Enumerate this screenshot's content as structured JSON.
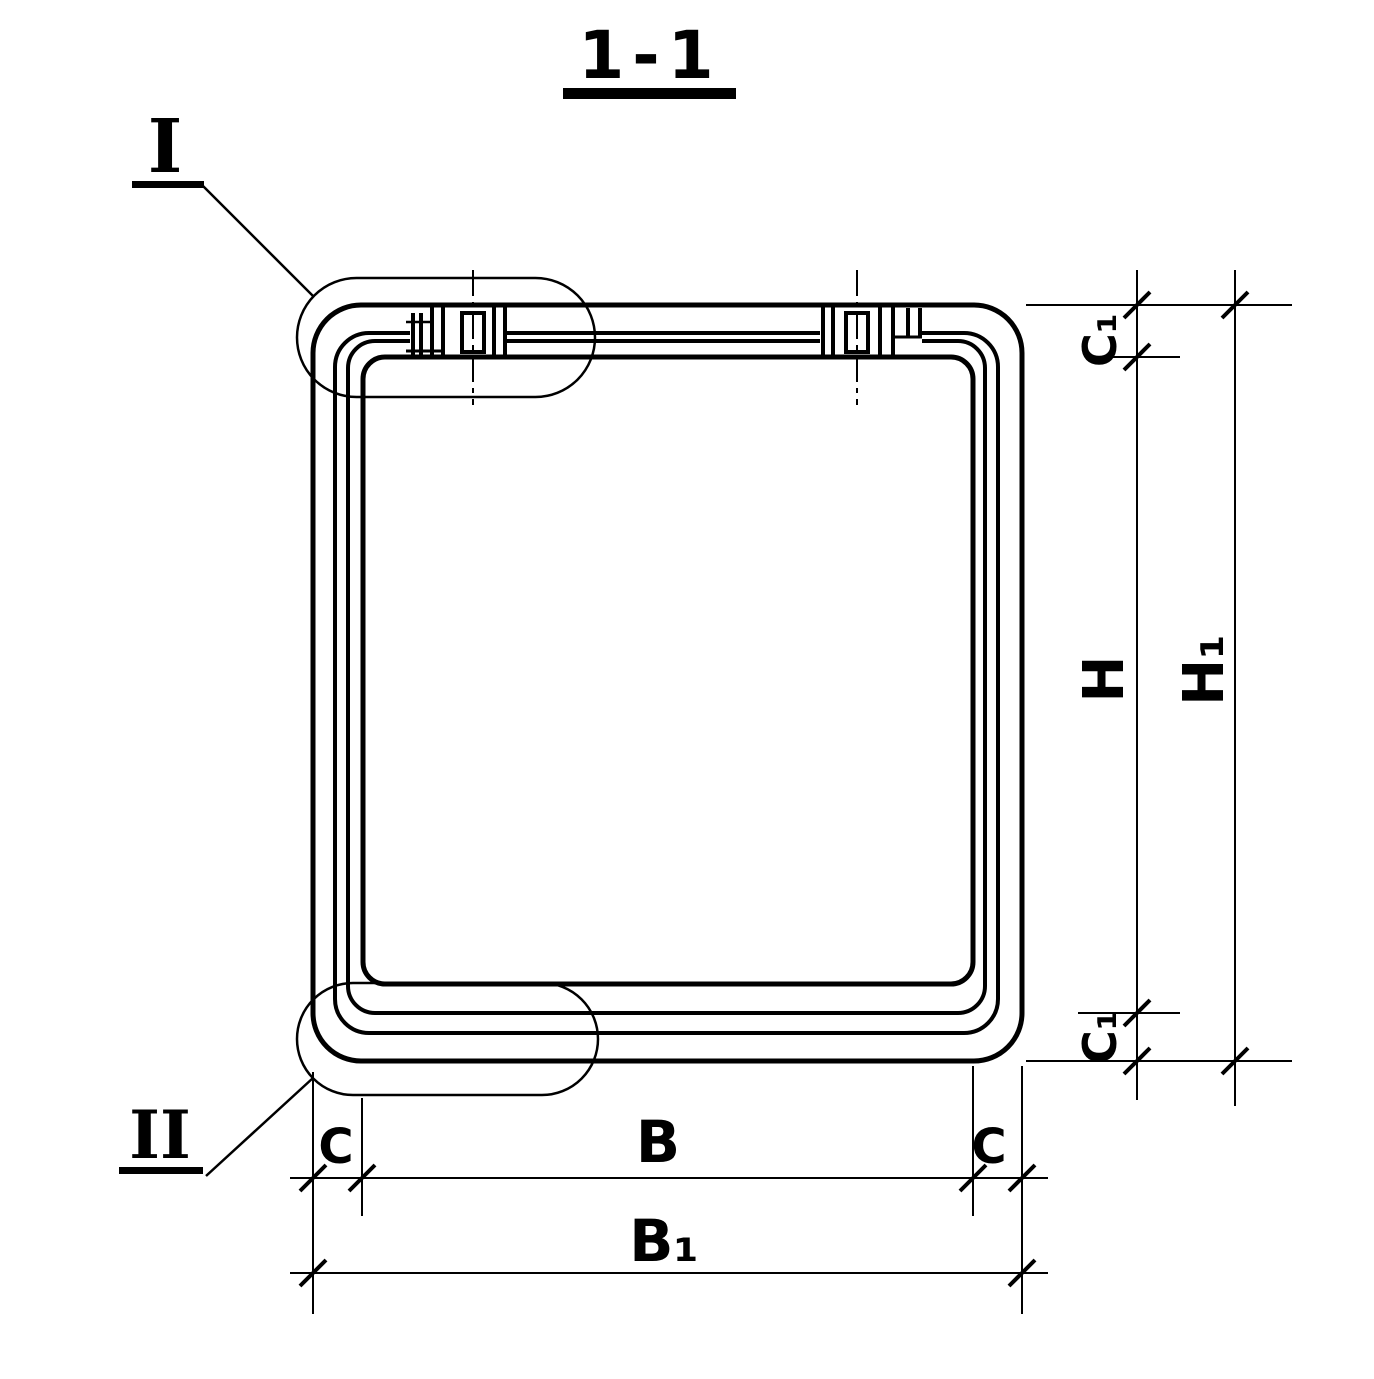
{
  "drawing": {
    "title": "1-1",
    "type_note": "section view of precast box culvert ring",
    "colors": {
      "ink": "#000000",
      "paper": "#ffffff"
    },
    "callouts": {
      "detail_1": "I",
      "detail_2": "II"
    },
    "dimensions": {
      "inner_height": "H",
      "outer_height": "H₁",
      "top_offset": "C₁",
      "bottom_offset": "C₁",
      "inner_width": "B",
      "outer_width": "B₁",
      "left_offset": "C",
      "right_offset": "C"
    }
  }
}
